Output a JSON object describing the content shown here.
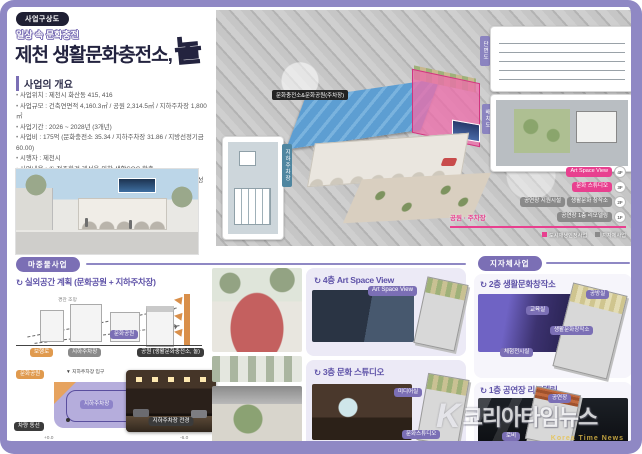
{
  "colors": {
    "frame": "#8f88c4",
    "accent_purple": "#7b6fb5",
    "pink": "#e8408f",
    "yellow": "#ffd92e",
    "navy": "#23233f"
  },
  "header": {
    "badge": "사업구상도",
    "tagline": "일상 속 문화충전",
    "title": "제천 생활문화충전소,",
    "accent": "놀"
  },
  "overview": {
    "heading": "사업의 개요",
    "bullets": [
      "사업위치 : 제천시 화산동 415, 416",
      "사업규모 : 건축연면적 4,160.3㎡ / 공원 2,314.5㎡ / 지하주차장 1,800㎡",
      "사업기간 : 2026 ~ 2028년 (3개년)",
      "사업비 : 175억 (문화충전소 35.34 / 지하주차장 31.86 / 지방선정기금 60.00)",
      "시행자 : 제천시",
      "사업내용 : ① 정주환경 개선을 위한 생활SOC 확충",
      "② 노후 공공시설 리모델링 기반의 생활문화 거점시설 조성"
    ]
  },
  "aerial": {
    "building_label": "문화충전소&문화공원(주차장)",
    "tab_section": "단면도",
    "tab_site": "배치도",
    "tab_parking": "지하주차장",
    "floor4_pill": "Art Space View",
    "floor4_tag": "4F",
    "floor3_pill": "문화 스튜디오",
    "floor3_tag": "3F",
    "floor2_pill_a": "공연장 지원시설",
    "floor2_pill_b": "생활문화 창작소",
    "floor2_tag": "2F",
    "floor1_park": "공원 · 주차장",
    "floor1_pill": "공연장 1층 리모델링",
    "floor1_tag": "1F",
    "legend_pink": "도시재생인정사업",
    "legend_gray": "지자체사업"
  },
  "priming": {
    "badge": "마중물사업",
    "heading": "실외공간 계획 (문화공원 + 지하주차장)",
    "sketch_note": "경관 조망",
    "sketch_pill_park": "문화공원",
    "sketch_pill_path": "보행로",
    "sketch_pill_parking": "지하주차장",
    "sketch_pill_main": "공원 (생활문화충전소, 놀)",
    "plan_pill_park": "문화공원",
    "plan_entry": "▼ 지하주차장 입구",
    "plan_pill_parking": "지하주차장",
    "plan_pill_circulation": "차량 동선",
    "plan_level_top": "+0.0",
    "plan_level_bottom": "-6.0",
    "plan_photo_pill": "지하주차장 전경"
  },
  "mid": {
    "panel4f_heading": "4층 Art Space View",
    "panel4f_pill": "Art Space View",
    "panel3f_heading": "3층 문화 스튜디오",
    "panel3f_pill_a": "미디어실",
    "panel3f_pill_b": "문화스튜디오"
  },
  "municipal": {
    "badge": "지자체사업",
    "panel2f_heading": "2층 생활문화창작소",
    "panel2f_pill_a": "공방실",
    "panel2f_pill_b": "교육실",
    "panel2f_pill_c": "생활문화창작소",
    "panel2f_pill_d": "체험전시실",
    "panel1f_heading": "1층 공연장 리모델링",
    "panel1f_pill_a": "공연장",
    "panel1f_pill_b": "로비"
  },
  "watermark": {
    "name": "코리아타임뉴스",
    "sub": "Korea Time News"
  }
}
